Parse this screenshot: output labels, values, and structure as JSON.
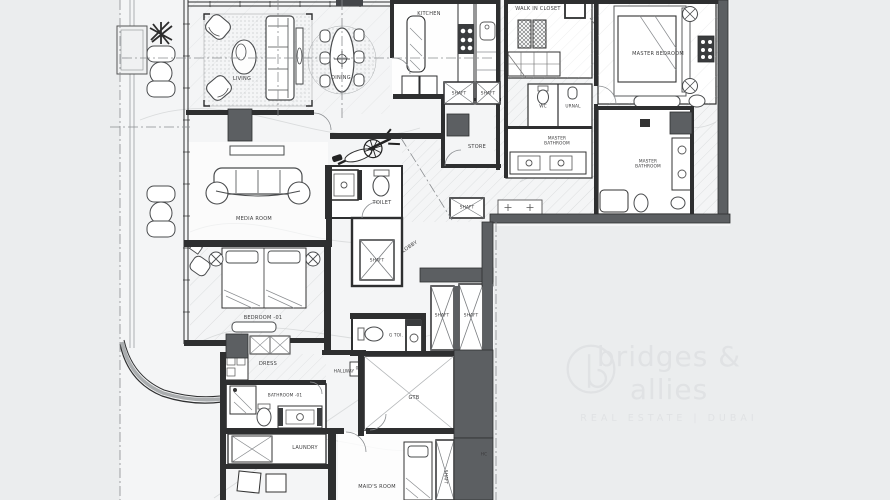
{
  "rooms": {
    "living": "LIVING",
    "dining": "DINING",
    "kitchen": "KITCHEN",
    "walk_in_closet": "WALK IN CLOSET",
    "master_bedroom": "MASTER BEDROOM",
    "wc": "WC",
    "urinal": "URNAL",
    "master_bathroom": "MASTER\nBATHROOM",
    "store": "STORE",
    "shaft": "SHAFT",
    "toilet": "TOILET",
    "lobby": "LOBBY",
    "media_room": "MEDIA ROOM",
    "bedroom_01": "BEDROOM -01",
    "dress": "DRESS",
    "bathroom_01": "BATHROOM -01",
    "hallway": "HALLWAY",
    "door_zero": "0",
    "g_toi": "G TOI.",
    "gtb": "GTB",
    "laundry": "LAUNDRY",
    "maids_room": "MAID'S ROOM",
    "hc": "HC"
  },
  "watermark": {
    "brand": "bridges & allies",
    "tagline": "REAL ESTATE | DUBAI"
  },
  "colors": {
    "bg": "#ebedee",
    "paper": "#f4f5f6",
    "room": "#ffffff",
    "line": "#2e2f30",
    "wall": "#5c5f62",
    "mid": "#9b9ea1",
    "topo": "#dadcdd",
    "hatch": "#c9cccd",
    "label": "#3b3b3c",
    "furn": "#4a4c4e",
    "watermark": "#e0e2e4"
  }
}
